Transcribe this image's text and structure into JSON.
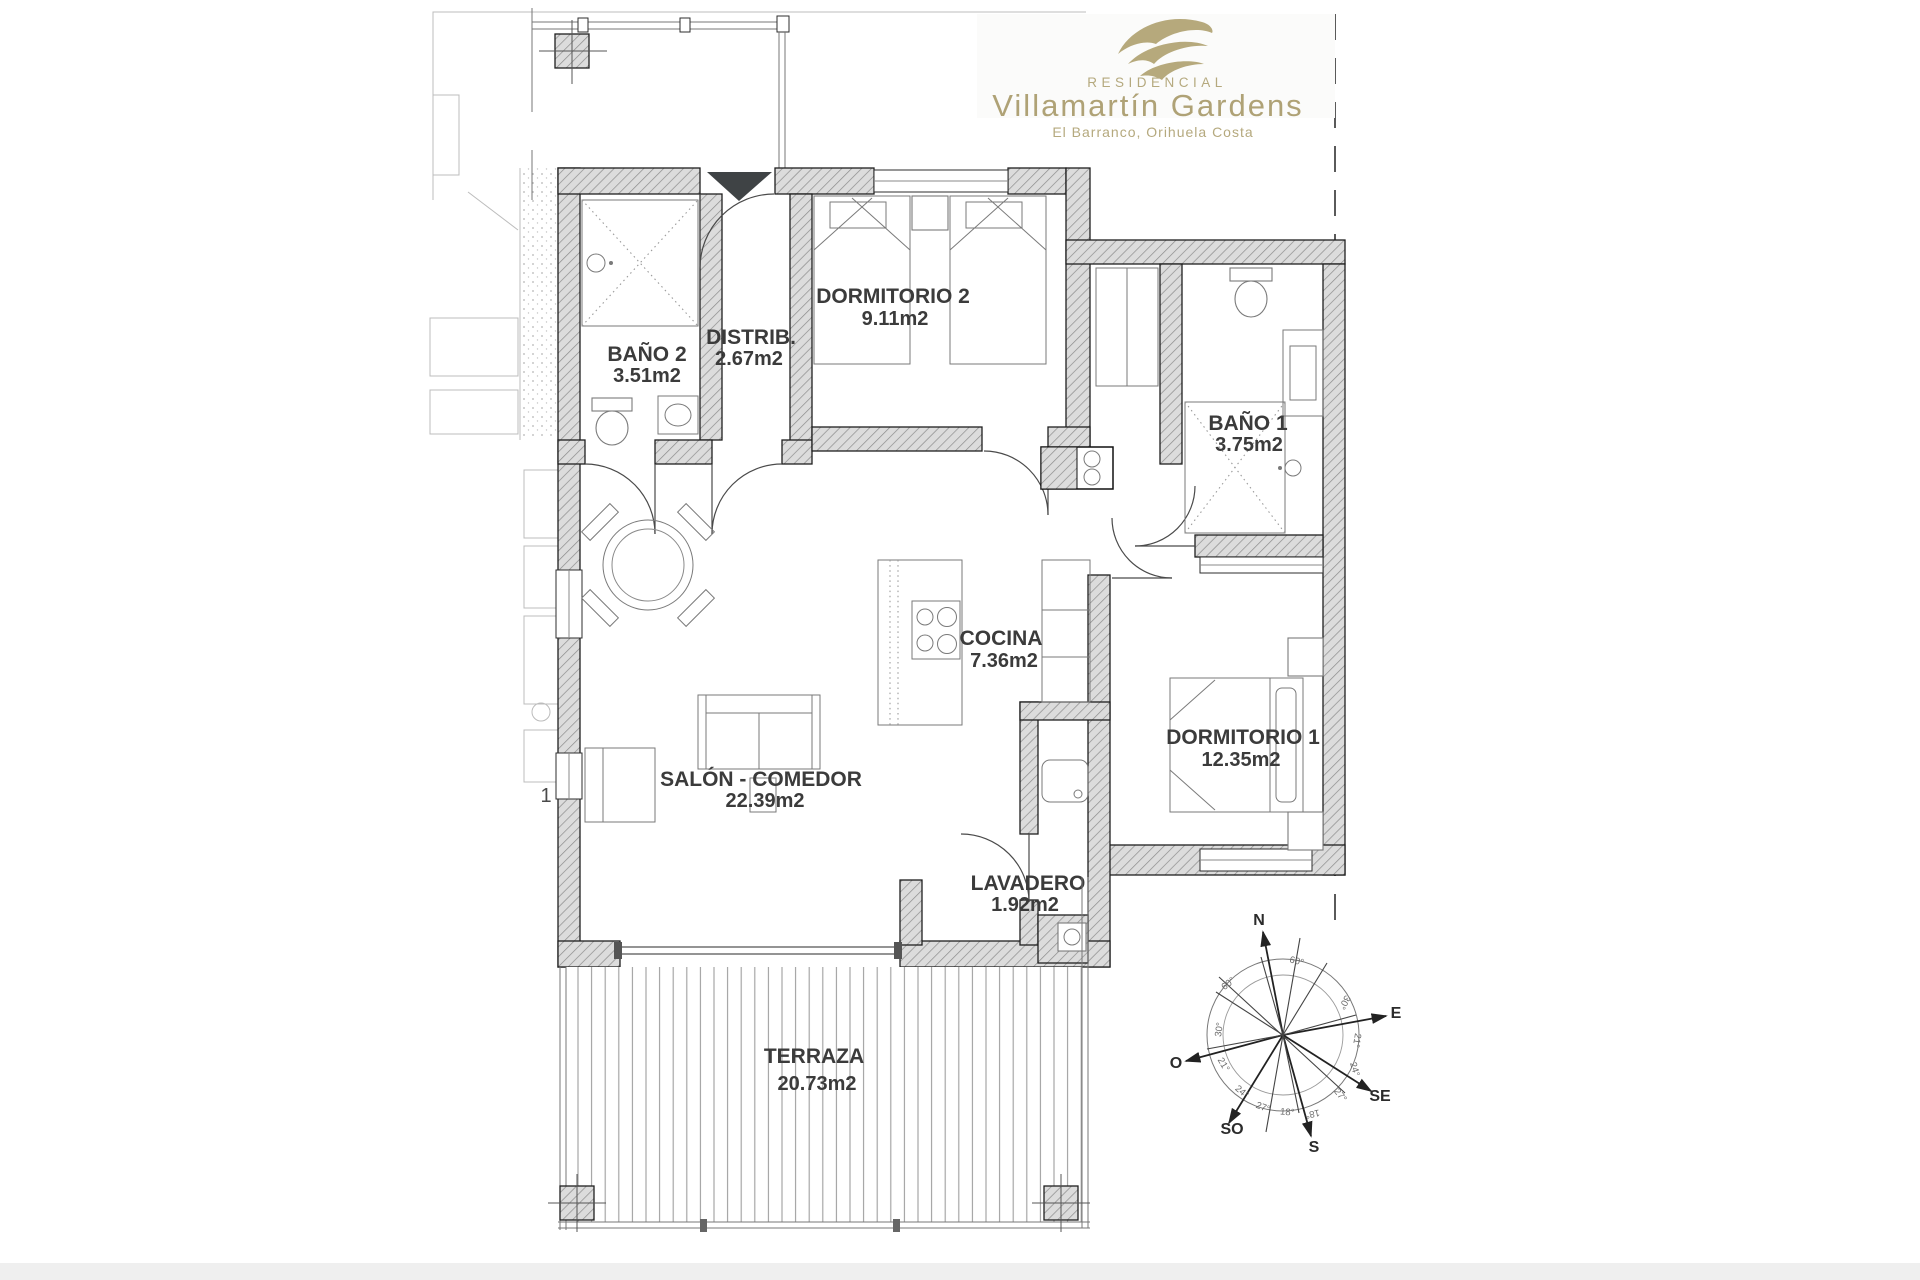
{
  "brand": {
    "tagline": "RESIDENCIAL",
    "name": "Villamartín Gardens",
    "location": "El Barranco, Orihuela Costa"
  },
  "rooms": [
    {
      "name": "DORMITORIO 2",
      "area": "9.11m2"
    },
    {
      "name": "DISTRIB.",
      "area": "2.67m2"
    },
    {
      "name": "BAÑO 2",
      "area": "3.51m2"
    },
    {
      "name": "BAÑO 1",
      "area": "3.75m2"
    },
    {
      "name": "COCINA",
      "area": "7.36m2"
    },
    {
      "name": "DORMITORIO 1",
      "area": "12.35m2"
    },
    {
      "name": "SALÓN - COMEDOR",
      "area": "22.39m2"
    },
    {
      "name": "LAVADERO",
      "area": "1.92m2"
    },
    {
      "name": "TERRAZA",
      "area": "20.73m2"
    }
  ],
  "compass": {
    "directions": {
      "n": "N",
      "e": "E",
      "o": "O",
      "s": "S",
      "se": "SE",
      "so": "SO"
    },
    "angles": [
      "60°",
      "60°",
      "30°",
      "30°",
      "21°",
      "21°",
      "24°",
      "24°",
      "27°",
      "27°",
      "18°",
      "18°"
    ]
  },
  "neighbor": {
    "unit_label": "1"
  },
  "colors": {
    "brand_gold": "#b0a379",
    "wall_fill": "#dcdcdc",
    "wall_hatch": "#8c8c8c",
    "label_ink": "#3b3b3b"
  }
}
